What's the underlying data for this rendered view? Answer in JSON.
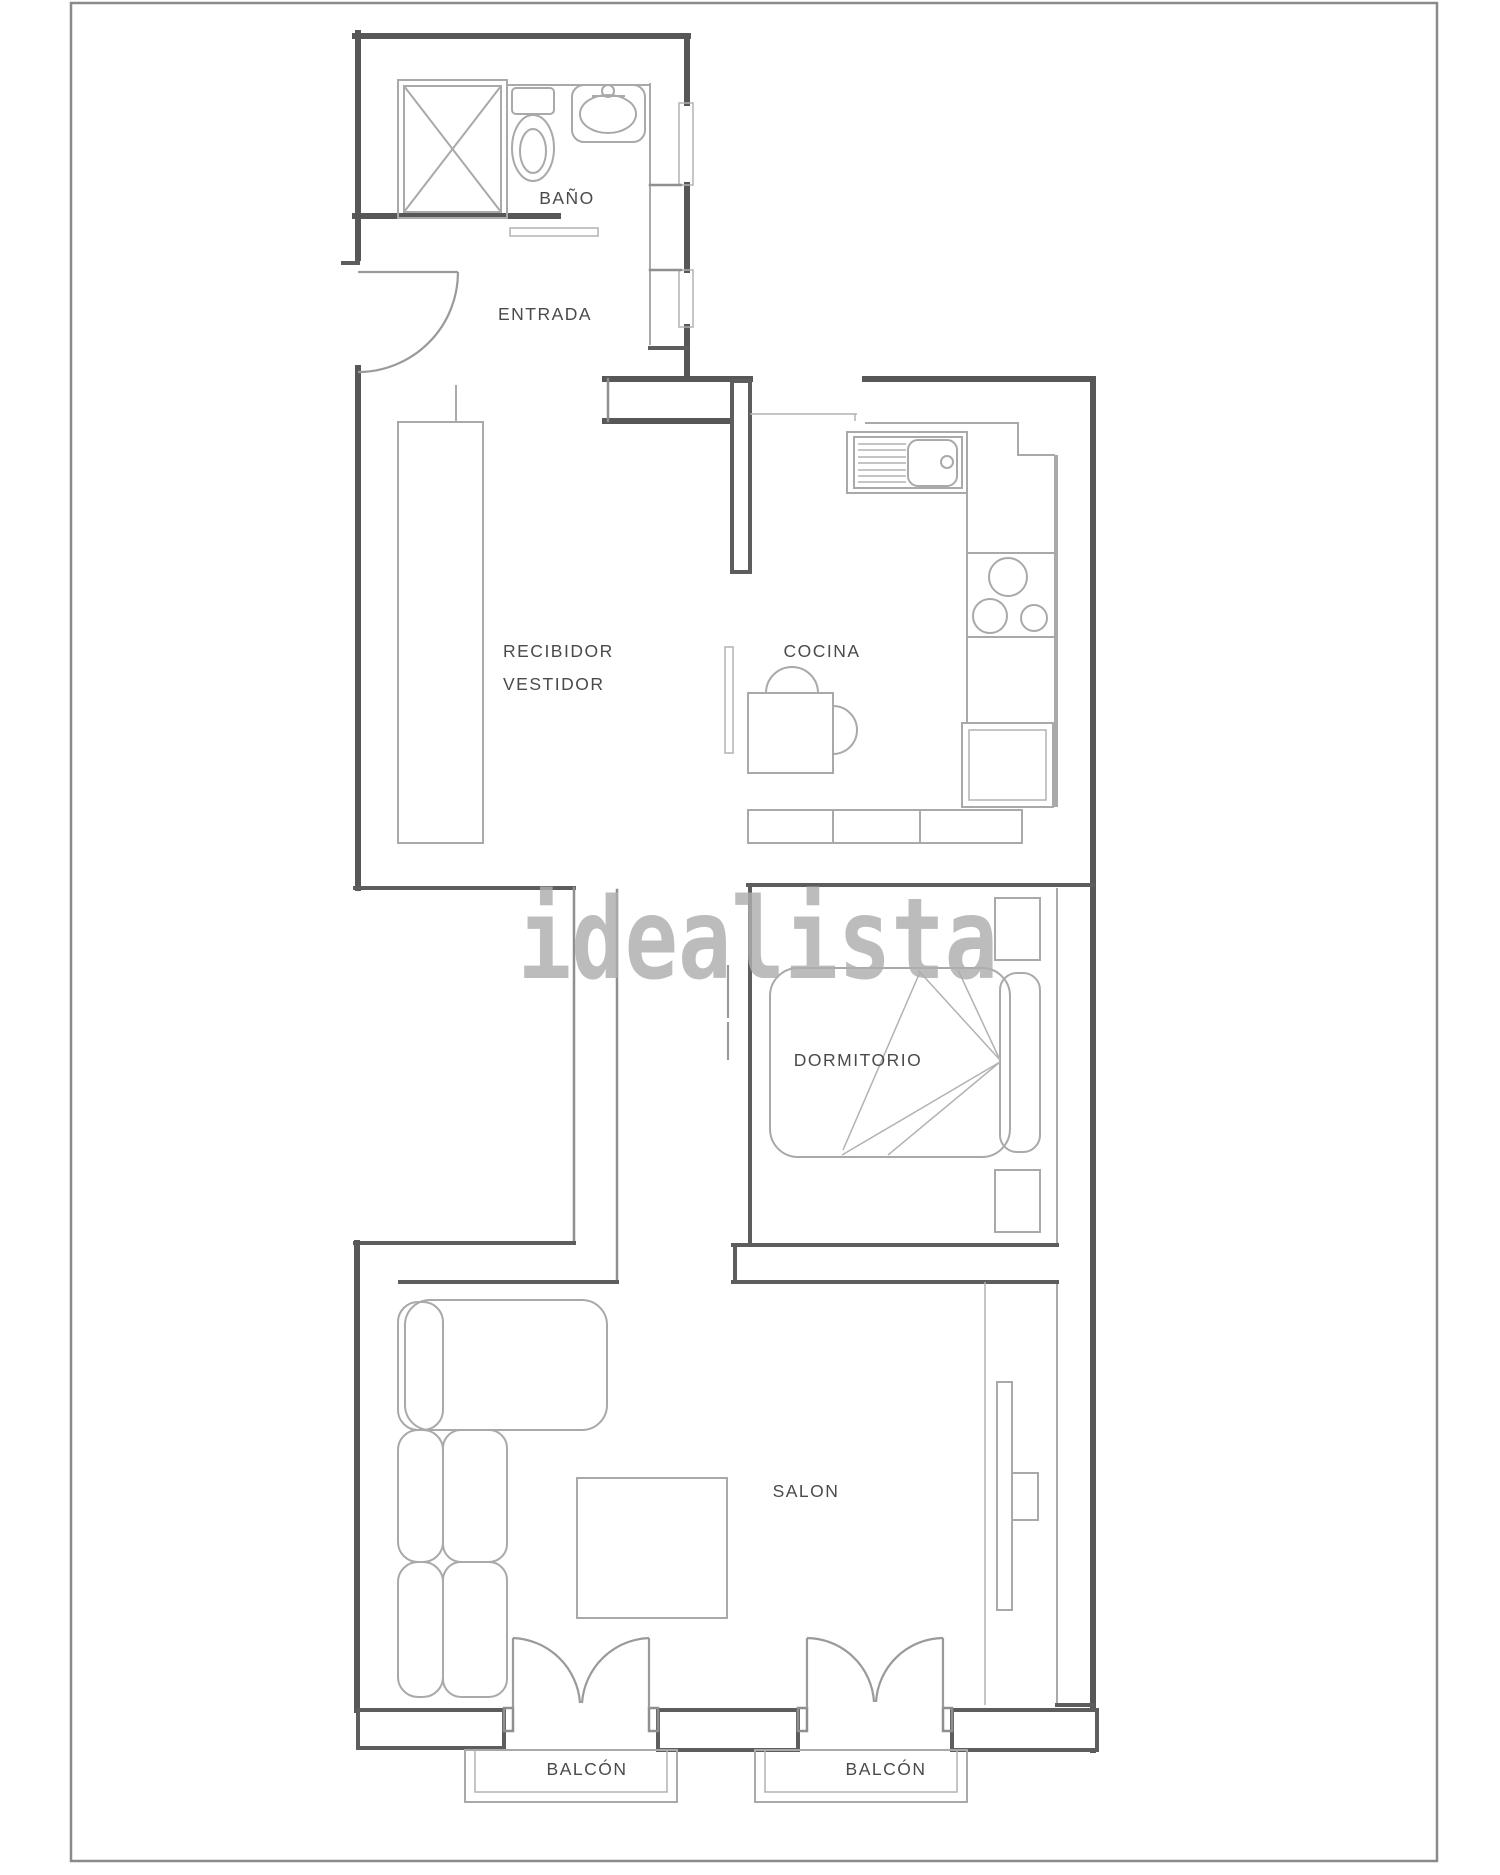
{
  "document": {
    "type": "floorplan",
    "background": "#ffffff",
    "border_color": "#8a8a8a"
  },
  "colors": {
    "wall": "#575757",
    "inner_wall": "#8f8f8f",
    "furniture": "#a9a9a9",
    "door": "#9a9a9a",
    "label": "#4a4a4a",
    "watermark": "#aeaeae"
  },
  "watermark": {
    "text": "idealista"
  },
  "rooms": [
    {
      "id": "bano",
      "label": "BAÑO"
    },
    {
      "id": "entrada",
      "label": "ENTRADA"
    },
    {
      "id": "recibidor",
      "label_line1": "RECIBIDOR",
      "label_line2": "VESTIDOR"
    },
    {
      "id": "cocina",
      "label": "COCINA"
    },
    {
      "id": "dormitorio",
      "label": "DORMITORIO"
    },
    {
      "id": "salon",
      "label": "SALON"
    },
    {
      "id": "balcon_izquierdo",
      "label": "BALCÓN"
    },
    {
      "id": "balcon_derecho",
      "label": "BALCÓN"
    }
  ],
  "furniture": [
    "shower",
    "toilet",
    "washbasin",
    "entry-door",
    "wardrobe",
    "kitchen-sink",
    "kitchen-counter",
    "stove-burners",
    "oven",
    "kitchen-table",
    "chairs",
    "double-bed",
    "pillow",
    "nightstand-top",
    "nightstand-bottom",
    "corner-sofa",
    "coffee-table",
    "tv-unit",
    "balcony-french-doors-left",
    "balcony-french-doors-right",
    "balcony-rail-left",
    "balcony-rail-right"
  ]
}
